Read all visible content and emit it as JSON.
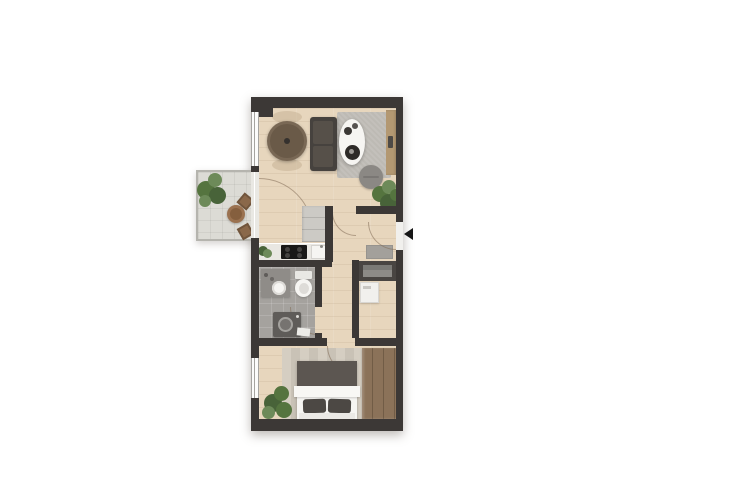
{
  "icons": {
    "entrance-arrow": "left-pointing-triangle"
  },
  "colors": {
    "wall": "#3c3836",
    "wood": "#e7d6bd",
    "bath": "#a5a29e",
    "balcony-floor": "#dcdbd5",
    "rail": "#b5b4ae",
    "rug-living": "#bdbab4",
    "rug-bed-a": "#d5cec2",
    "rug-bed-b": "#c9c2b6",
    "sofa": "#46423e",
    "cushion": "#565049",
    "table-wood": "#796855",
    "table-wood-inner": "#6a5a48",
    "white-surface": "#f6f5f2",
    "tray": "#2d2a27",
    "pouf": "#8b8884",
    "sideboard": "#b39872",
    "decor-dark": "#4e4a46",
    "cabinet": "#cccac5",
    "counter": "#e9e7e2",
    "cooktop": "#191817",
    "burner": "#454341",
    "vanity": "#8f8c88",
    "washer": "#5f5c59",
    "washer-ring": "#a3a19d",
    "washer-inner": "#767370",
    "closet": "#494542",
    "shelf": "#8d8b87",
    "mat": "#a3a09b",
    "blanket": "#5c5651",
    "pillow": "#4c4844",
    "sheet": "#f8f7f4",
    "headboard": "#ebe9e5",
    "wardrobe": "#8b7259",
    "wardrobe-line": "#715c46",
    "green-a": "#55743f",
    "green-b": "#486339",
    "green-c": "#6d8a59",
    "chair-brown": "#8a684a",
    "table-brown": "#9b7250",
    "table-brown-inner": "#855f3e",
    "arc": "rgba(130,108,86,0.55)",
    "arrow": "#161616",
    "window-fill": "#fcfcfb",
    "window-frame": "#a6a4a0",
    "glass": "#e9e8e3",
    "door-panel": "#f1f0ed"
  }
}
